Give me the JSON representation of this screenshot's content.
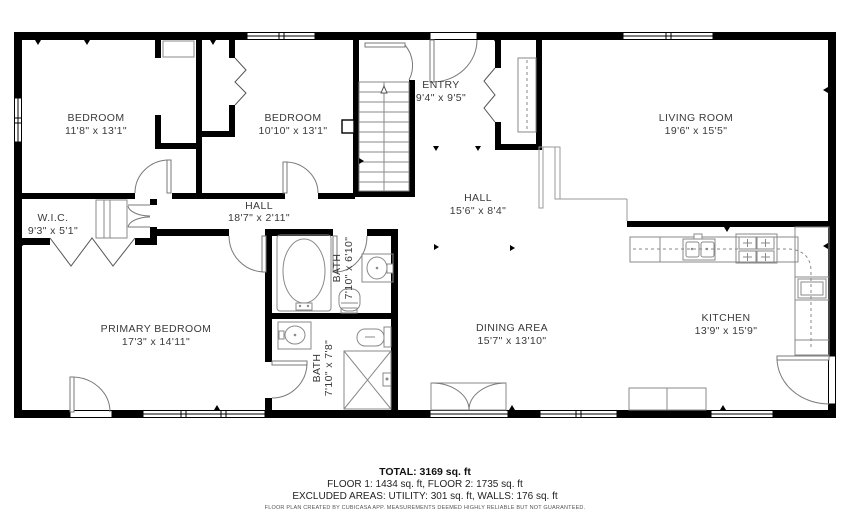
{
  "rooms": [
    {
      "label": "BEDROOM",
      "dims": "11'8\" x 13'1\""
    },
    {
      "label": "BEDROOM",
      "dims": "10'10\" x 13'1\""
    },
    {
      "label": "ENTRY",
      "dims": "9'4\" x 9'5\""
    },
    {
      "label": "LIVING ROOM",
      "dims": "19'6\" x 15'5\""
    },
    {
      "label": "HALL",
      "dims": "18'7\" x 2'11\""
    },
    {
      "label": "HALL",
      "dims": "15'6\" x 8'4\""
    },
    {
      "label": "W.I.C.",
      "dims": "9'3\" x 5'1\""
    },
    {
      "label": "PRIMARY BEDROOM",
      "dims": "17'3\" x 14'11\""
    },
    {
      "label": "DINING AREA",
      "dims": "15'7\" x 13'10\""
    },
    {
      "label": "KITCHEN",
      "dims": "13'9\" x 15'9\""
    },
    {
      "label": "BATH",
      "dims": "7'10\" x 6'10\""
    },
    {
      "label": "BATH",
      "dims": "7'10\" x 7'8\""
    }
  ],
  "footer": {
    "total": "TOTAL: 3169 sq. ft",
    "floors": "FLOOR 1: 1434 sq. ft, FLOOR 2: 1735 sq. ft",
    "excluded": "EXCLUDED AREAS: UTILITY: 301 sq. ft, WALLS: 176 sq. ft",
    "disclaimer": "FLOOR PLAN CREATED BY CUBICASA APP. MEASUREMENTS DEEMED HIGHLY RELIABLE BUT NOT GUARANTEED."
  },
  "colors": {
    "walls": "#000000",
    "fixtures": "#8a8a8a",
    "label_text": "#3a3a3a"
  }
}
